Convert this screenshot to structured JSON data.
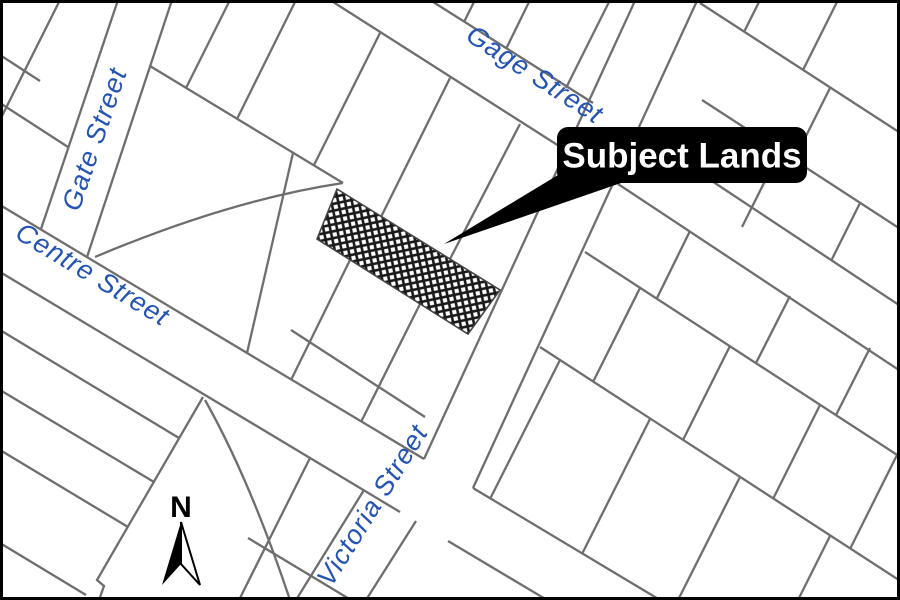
{
  "map": {
    "title": "Subject Lands location map",
    "colors": {
      "background": "#ffffff",
      "frame_border": "#000000",
      "parcel_line": "#6e6e6e",
      "street_label": "#2353b5",
      "hatch": "#1a1a1a",
      "callout_bg": "#000000",
      "callout_text": "#ffffff",
      "north_arrow": "#000000"
    },
    "street_labels": [
      {
        "id": "gage-street",
        "text": "Gage Street",
        "x": 530,
        "y": 82,
        "rotate": 33,
        "size": 27
      },
      {
        "id": "gate-street",
        "text": "Gate Street",
        "x": 103,
        "y": 142,
        "rotate": -71,
        "size": 27
      },
      {
        "id": "centre-street",
        "text": "Centre Street",
        "x": 88,
        "y": 282,
        "rotate": 31,
        "size": 27
      },
      {
        "id": "victoria-street",
        "text": "Victoria Street",
        "x": 380,
        "y": 510,
        "rotate": -58,
        "size": 27
      }
    ],
    "segments": [
      [
        118,
        0,
        41,
        229
      ],
      [
        172,
        0,
        87,
        257
      ],
      [
        430,
        0,
        593,
        103
      ],
      [
        641,
        134,
        908,
        311
      ],
      [
        330,
        0,
        570,
        153
      ],
      [
        618,
        184,
        908,
        376
      ],
      [
        0,
        205,
        424,
        459
      ],
      [
        473,
        488,
        660,
        600
      ],
      [
        0,
        272,
        400,
        512
      ],
      [
        448,
        541,
        547,
        600
      ],
      [
        640,
        -10,
        424,
        459
      ],
      [
        702,
        -10,
        473,
        488
      ],
      [
        364,
        490,
        296,
        600
      ],
      [
        416,
        521,
        366,
        600
      ],
      [
        475,
        0,
        464,
        22
      ],
      [
        530,
        0,
        506,
        49
      ],
      [
        610,
        0,
        566,
        88
      ],
      [
        700,
        3,
        905,
        136
      ],
      [
        702,
        100,
        905,
        232
      ],
      [
        760,
        0,
        744,
        32
      ],
      [
        838,
        0,
        803,
        70
      ],
      [
        830,
        88,
        794,
        160
      ],
      [
        780,
        151,
        742,
        227
      ],
      [
        860,
        203,
        831,
        261
      ],
      [
        150,
        66,
        343,
        183
      ],
      [
        230,
        0,
        186,
        88
      ],
      [
        296,
        0,
        237,
        119
      ],
      [
        380,
        33,
        314,
        165
      ],
      [
        450,
        78,
        381,
        217
      ],
      [
        520,
        124,
        450,
        259
      ],
      [
        293,
        153,
        247,
        353
      ],
      [
        350,
        260,
        291,
        380
      ],
      [
        420,
        304,
        361,
        422
      ],
      [
        291,
        330,
        425,
        417
      ],
      [
        0,
        103,
        68,
        147
      ],
      [
        60,
        0,
        0,
        120
      ],
      [
        0,
        55,
        40,
        81
      ],
      [
        0,
        330,
        179,
        438
      ],
      [
        0,
        390,
        154,
        482
      ],
      [
        0,
        450,
        128,
        527
      ],
      [
        0,
        543,
        86,
        595
      ],
      [
        310,
        458,
        239,
        600
      ],
      [
        248,
        538,
        351,
        600
      ],
      [
        585,
        252,
        905,
        460
      ],
      [
        540,
        347,
        905,
        584
      ],
      [
        690,
        231,
        657,
        298
      ],
      [
        790,
        296,
        756,
        363
      ],
      [
        870,
        348,
        836,
        415
      ],
      [
        640,
        288,
        593,
        382
      ],
      [
        730,
        346,
        683,
        440
      ],
      [
        820,
        405,
        773,
        499
      ],
      [
        897,
        455,
        850,
        549
      ],
      [
        560,
        360,
        490,
        499
      ],
      [
        650,
        419,
        582,
        554
      ],
      [
        740,
        477,
        678,
        600
      ],
      [
        830,
        536,
        798,
        600
      ]
    ],
    "curves": [
      "M95,257 Q230,200 343,183",
      "M205,400 Q250,480 290,600",
      "M203,397 L97,580 L104,586 L99,600"
    ],
    "subject_parcel": {
      "name": "Subject Lands parcel",
      "points": "337,189 500,290 468,334 317,239"
    },
    "callout": {
      "label": "Subject Lands",
      "box": {
        "x": 557,
        "y": 127,
        "w": 250,
        "h": 56,
        "r": 11
      },
      "font_size": 35,
      "leader_points": "563,172 621,183 444,244"
    },
    "north_arrow": {
      "letter": "N",
      "cx": 181,
      "letter_baseline_y": 517,
      "tip_y": 522,
      "base_y": 585,
      "half_width": 19,
      "notch_y": 564
    }
  }
}
